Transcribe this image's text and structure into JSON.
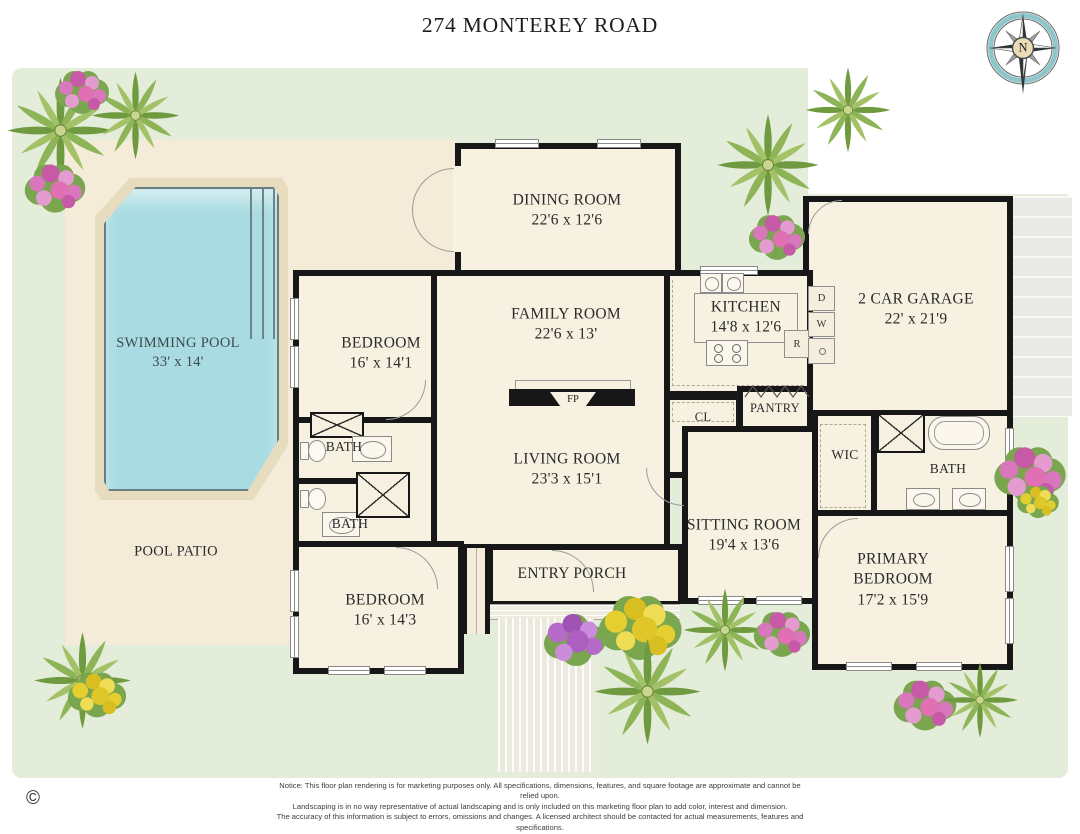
{
  "title": "274 MONTEREY ROAD",
  "compass": {
    "north": "N"
  },
  "pool": {
    "name": "SWIMMING POOL",
    "dims": "33' x 14'"
  },
  "patio": {
    "name": "POOL PATIO"
  },
  "rooms": {
    "dining": {
      "name": "DINING ROOM",
      "dims": "22'6 x 12'6"
    },
    "family": {
      "name": "FAMILY ROOM",
      "dims": "22'6 x 13'"
    },
    "kitchen": {
      "name": "KITCHEN",
      "dims": "14'8 x 12'6"
    },
    "garage": {
      "name": "2 CAR GARAGE",
      "dims": "22' x 21'9"
    },
    "bedroom_upper": {
      "name": "BEDROOM",
      "dims": "16' x 14'1"
    },
    "bedroom_lower": {
      "name": "BEDROOM",
      "dims": "16' x 14'3"
    },
    "living": {
      "name": "LIVING ROOM",
      "dims": "23'3 x 15'1"
    },
    "sitting": {
      "name": "SITTING ROOM",
      "dims": "19'4 x 13'6"
    },
    "primary": {
      "name": "PRIMARY BEDROOM",
      "dims": "17'2 x 15'9"
    },
    "entry_porch": {
      "name": "ENTRY PORCH"
    },
    "bath_upper": {
      "name": "BATH"
    },
    "bath_lower": {
      "name": "BATH"
    },
    "bath_primary": {
      "name": "BATH"
    },
    "wic": {
      "name": "WIC"
    },
    "closet": {
      "name": "CL"
    },
    "pantry": {
      "name": "PANTRY"
    }
  },
  "fixtures": {
    "fireplace": "FP"
  },
  "appliances": {
    "dryer": "D",
    "washer": "W",
    "refrigerator": "R"
  },
  "notice": {
    "label": "Notice:",
    "lines": [
      "This floor plan rendering is for marketing purposes only. All specifications, dimensions, features, and square footage are approximate and cannot be relied upon.",
      "Landscaping is in no way representative of actual landscaping and is only included on this marketing floor plan to add color, interest and dimension.",
      "The accuracy of this information is subject to errors, omissions and changes. A licensed architect should be contacted for actual measurements, features and specifications."
    ]
  },
  "copyright": "©",
  "colors": {
    "lawn": "#e3edda",
    "patio": "#f4ecd9",
    "room": "#f7f1e2",
    "wall": "#171717",
    "pool_water": "#a9dce2",
    "pool_deck": "#e7dcbd",
    "compass_ring": "#8fc6ca"
  }
}
